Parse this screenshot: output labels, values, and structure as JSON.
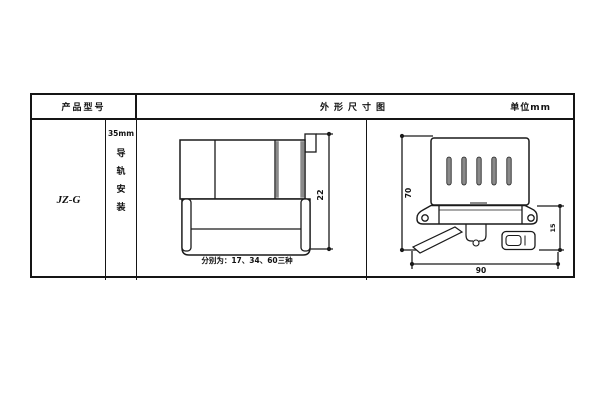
{
  "header": {
    "product_model_label": "产品型号",
    "dimension_title": "外形尺寸图",
    "unit_label": "单位mm"
  },
  "product": {
    "model": "JZ-G",
    "rail_width": "35mm",
    "rail_chars": [
      "导",
      "轨",
      "安",
      "装"
    ]
  },
  "front_view": {
    "height_dim": "22",
    "width_note": "分别为：17、34、60三种"
  },
  "side_view": {
    "height_dim": "70",
    "clip_height_dim": "15",
    "width_dim": "90"
  },
  "colors": {
    "line": "#1a1a1a",
    "shade": "#8a8a8a",
    "background": "#ffffff"
  }
}
